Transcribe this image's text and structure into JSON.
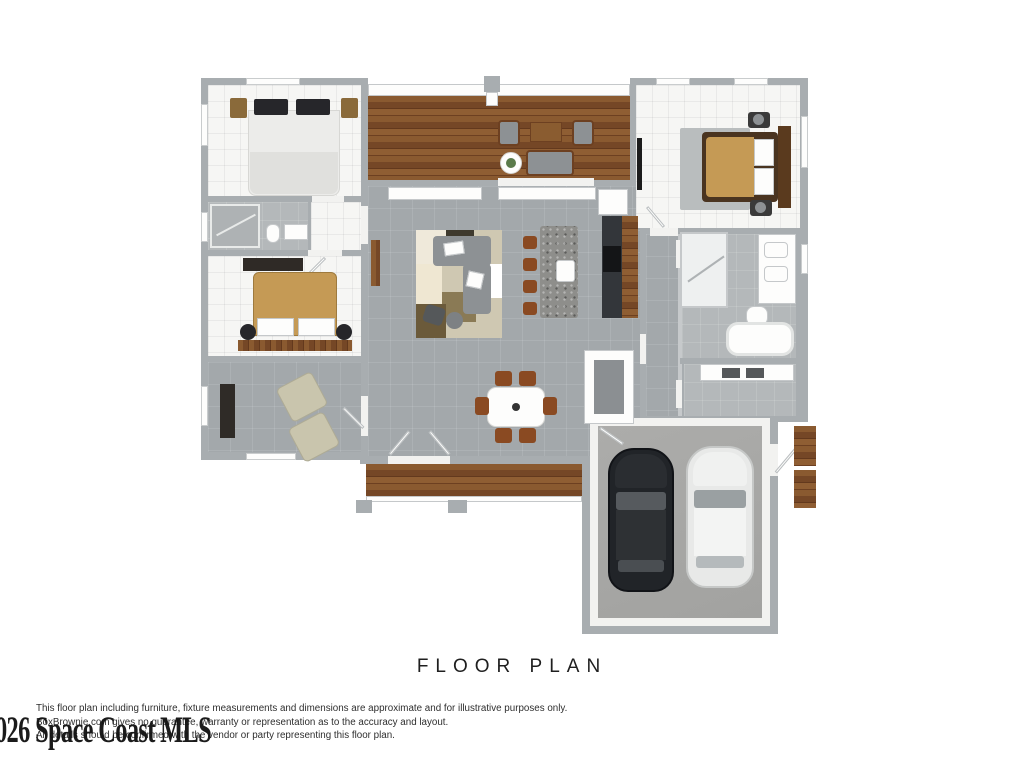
{
  "title": "FLOOR PLAN",
  "disclaimer": {
    "line1": "This floor plan including furniture, fixture measurements and dimensions are approximate and for illustrative purposes only.",
    "line2": "BoxBrownie.com gives no guarantee, warranty or representation as to the accuracy and layout.",
    "line3": "All details should be confirmed with the vendor or party representing this floor plan."
  },
  "watermark": "026 Space Coast MLS",
  "colors": {
    "wall_gray": "#a8adb0",
    "tile_gray": "#a3a8ab",
    "tile_light": "#b4b8ba",
    "floor_white": "#f6f6f4",
    "garage_floor": "#a7a7a5",
    "bed_tan": "#c59a55",
    "dark_wood": "#5a3a1e",
    "sofa_gray": "#8d9194",
    "chair_beige": "#c9c5ad",
    "chair_brown": "#8a4a22",
    "car_black": "#212428",
    "car_white": "#e8e9e8"
  }
}
